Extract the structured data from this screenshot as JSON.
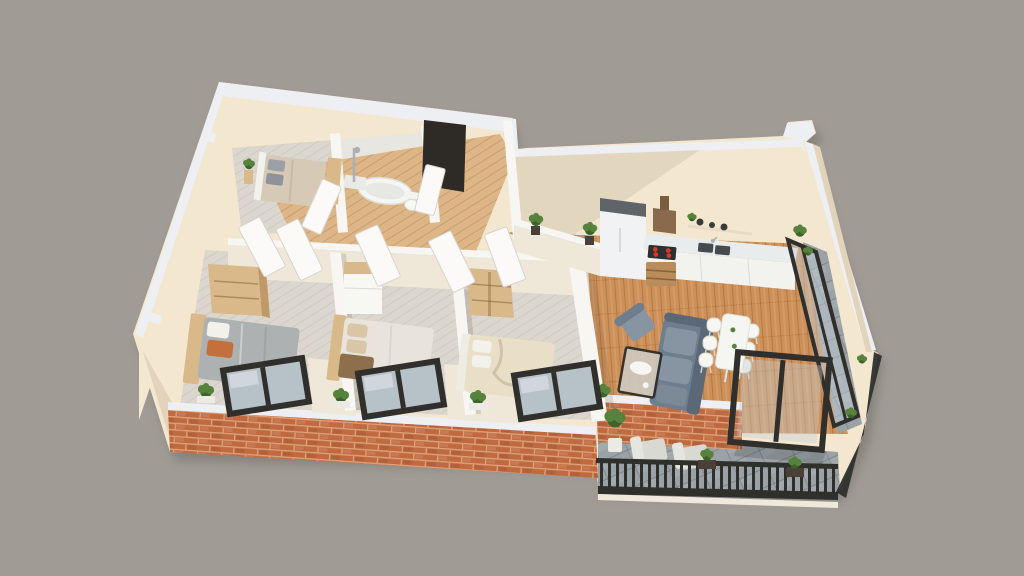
{
  "scene": {
    "type": "3d-floor-plan-render",
    "view": "isometric-3d",
    "background": "#a19b95"
  },
  "palette": {
    "background": "#a19b95",
    "drop_shadow": "#7e7972",
    "outer_wall_white": "#edeff2",
    "wall_cream": "#f3e7d0",
    "wall_cream_shadow": "#e2d3ba",
    "interior_wall_white": "#f7f6f3",
    "interior_wall_face": "#efe8d9",
    "oak_floor": "#cd9058",
    "oak_floor_pale": "#ddb586",
    "bedroom_floor": "#dbd6ce",
    "bathroom_floor": "#e8e6e1",
    "balcony_tile": "#9aa2a6",
    "brick": "#c06a41",
    "brick_mortar": "#dfa277",
    "window_frame": "#302f2b",
    "glass": "#c3ced6",
    "entry_door": "#2e2a26",
    "sofa": "#6f7e8e",
    "sofa_dark": "#5a6877",
    "sofa_cushion": "#8795a3",
    "white_furniture": "#f7f7f4",
    "counter_top": "#e9eced",
    "fridge_top": "#5e6468",
    "hood_brown": "#8a6a4c",
    "burner_red": "#d63a25",
    "oak_furniture": "#d9b88a",
    "oak_furniture_dark": "#bf9a68",
    "duvet_gray": "#aeb1b2",
    "duvet_white": "#e8e4dc",
    "duvet_cream": "#e9dec6",
    "duvet_beige": "#d6c9b6",
    "pillow_white": "#f2f1ec",
    "pillow_beige": "#d8c6a6",
    "pillow_orange": "#c2713d",
    "throw_brown": "#8d6f4e",
    "plant": "#57823d",
    "plant_dark": "#3c6329",
    "pot_white": "#eceae4",
    "pot_dark": "#4a4038",
    "lounge_chair": "#d9d9d3",
    "railing": "#2f2f2c",
    "metal": "#aab1b6"
  },
  "inventory": {
    "rooms": [
      "bedroom-1",
      "bedroom-2",
      "bedroom-3",
      "small-bedroom",
      "bathroom",
      "entry-hall",
      "open-kitchen",
      "living-dining",
      "front-balcony",
      "side-balcony"
    ],
    "bedroom_double_beds": 3,
    "single_beds": 1,
    "wardrobes": 3,
    "bathroom_fixtures": [
      "bathtub",
      "shower",
      "toilet"
    ],
    "kitchen_items": [
      "fridge",
      "range-hood",
      "cooktop-4-burners",
      "sink",
      "counter-run",
      "wall-shelf-with-pots",
      "wicker-crate"
    ],
    "living_items": [
      "sofa",
      "armchair",
      "coffee-table"
    ],
    "dining_table": 1,
    "dining_chairs": 6,
    "front_windows": 3,
    "glass_doors": 2,
    "entry_doors": 1,
    "interior_door_leaves": 7,
    "balcony_lounge_chairs": 2,
    "potted_plants": 14
  }
}
